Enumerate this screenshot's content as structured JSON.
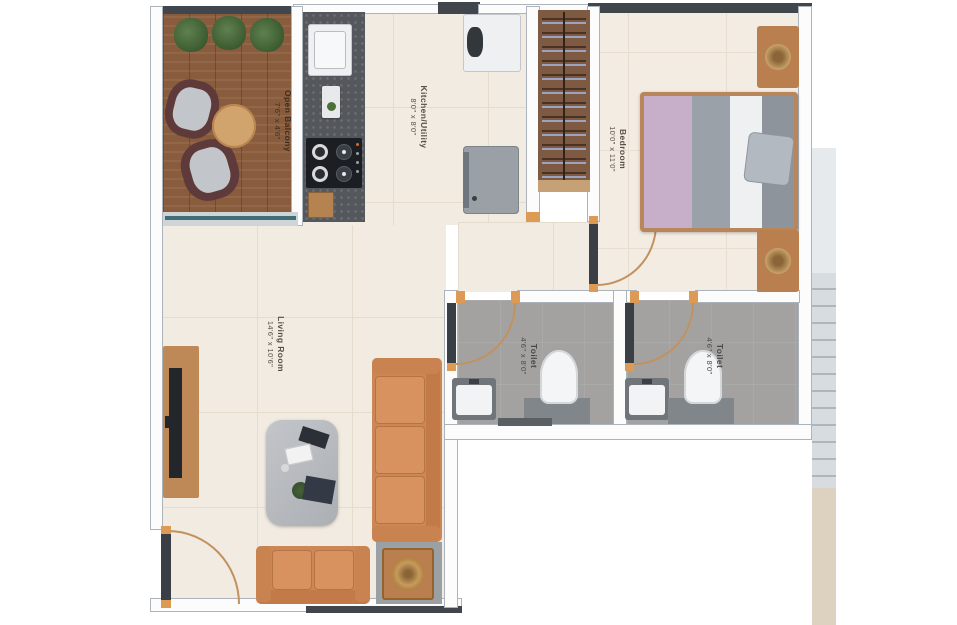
{
  "meta": {
    "type": "apartment-floor-plan"
  },
  "rooms": {
    "balcony": {
      "label": "Open Balcony",
      "dims": "7'6\" x 4'6\""
    },
    "kitchen": {
      "label": "Kitchen/Utility",
      "dims": "8'0\" x 8'0\""
    },
    "bedroom": {
      "label": "Bedroom",
      "dims": "10'0\" x 11'0\""
    },
    "living": {
      "label": "Living Room",
      "dims": "14'6\" x 10'6\""
    },
    "toilet1": {
      "label": "Toilet",
      "dims": "4'6\" x 8'0\""
    },
    "toilet2": {
      "label": "Toilet",
      "dims": "4'6\" x 8'0\""
    }
  },
  "furniture": [
    "balcony-plants",
    "balcony-chairs",
    "balcony-round-table",
    "kitchen-counter",
    "kitchen-sink",
    "gas-stove",
    "refrigerator",
    "washing-machine",
    "wardrobe",
    "double-bed",
    "nightstands",
    "tv-console",
    "coffee-table",
    "three-seater-sofa",
    "two-seater-sofa",
    "side-table",
    "washbasin",
    "water-closet",
    "staircase"
  ],
  "colors": {
    "floor_tile": "#f2ebe1",
    "deck_wood": "#8a5c3e",
    "wall_dark": "#41464c",
    "door_accent": "#dd9a55",
    "sofa_orange": "#cd8655",
    "bed_blanket": "#c7afc9",
    "toilet_floor": "#a3a2a0",
    "counter_granite": "#54585d"
  }
}
